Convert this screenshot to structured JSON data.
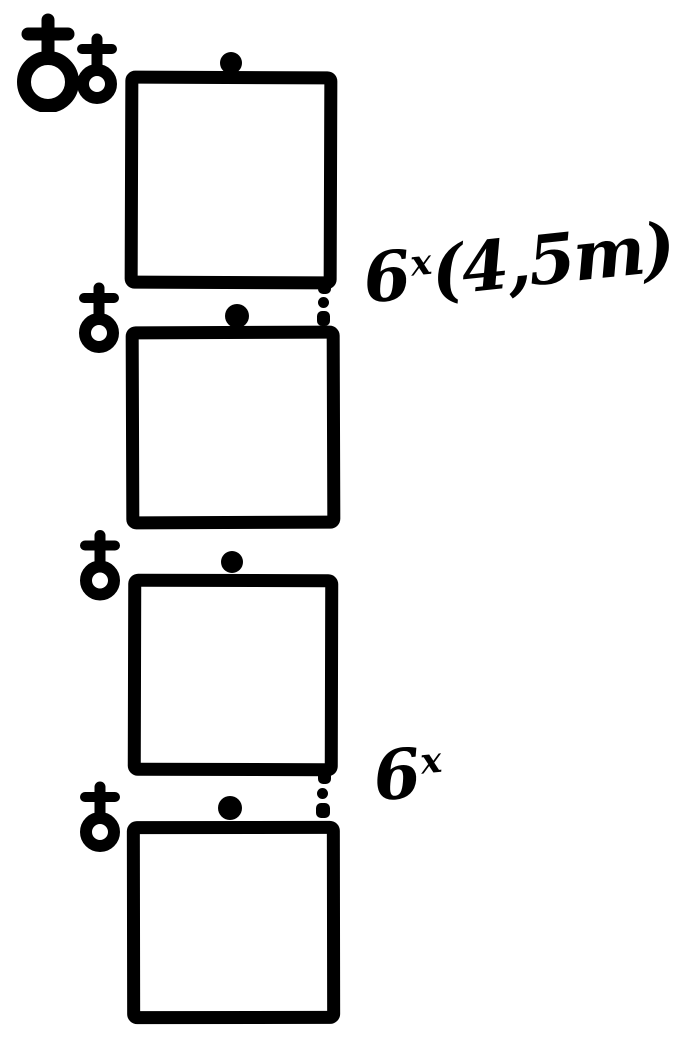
{
  "figure": {
    "type": "hand-drawn plant crossing diagram",
    "background_color": "#ffffff",
    "ink_color": "#000000"
  },
  "labels": [
    {
      "base": "6",
      "sup": "x",
      "suffix": "(4,5m)"
    },
    {
      "base": "6",
      "sup": "x",
      "suffix": ""
    }
  ],
  "icons": {
    "circle_cross_symbol": "♁",
    "offspring_dot": "●",
    "connector_dot": "•"
  }
}
